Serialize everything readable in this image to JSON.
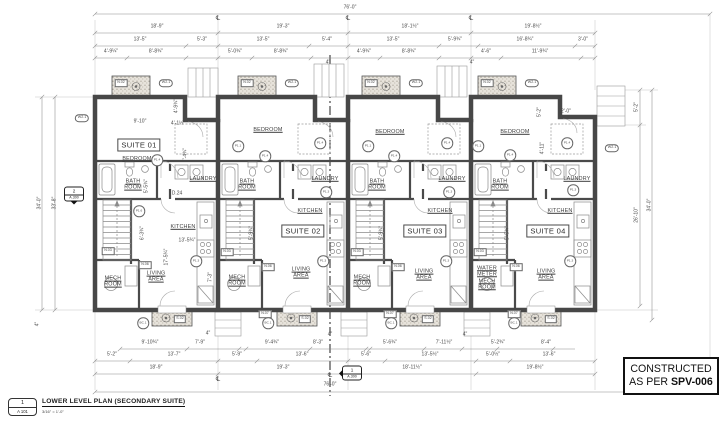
{
  "title_block": {
    "detail_number": "1",
    "sheet_ref": "A 101",
    "title": "LOWER LEVEL PLAN (SECONDARY SUITE)",
    "scale": "3/16\" = 1'-0\""
  },
  "stamp": {
    "line1": "CONSTRUCTED",
    "line2_prefix": "AS PER",
    "code": "SPV-006"
  },
  "plan": {
    "suite_labels": [
      {
        "t": "SUITE 01",
        "x": 139,
        "y": 145
      },
      {
        "t": "SUITE 02",
        "x": 303,
        "y": 231
      },
      {
        "t": "SUITE 03",
        "x": 425,
        "y": 231
      },
      {
        "t": "SUITE 04",
        "x": 548,
        "y": 231
      }
    ],
    "room_labels": [
      {
        "t": "BEDROOM",
        "x": 137,
        "y": 159
      },
      {
        "t": "BEDROOM",
        "x": 268,
        "y": 130
      },
      {
        "t": "BEDROOM",
        "x": 390,
        "y": 132
      },
      {
        "t": "BEDROOM",
        "x": 515,
        "y": 132
      },
      {
        "t": "BATH\nROOM",
        "x": 133,
        "y": 185
      },
      {
        "t": "BATH\nROOM",
        "x": 247,
        "y": 185
      },
      {
        "t": "BATH\nROOM",
        "x": 377,
        "y": 185
      },
      {
        "t": "BATH\nROOM",
        "x": 500,
        "y": 185
      },
      {
        "t": "LAUNDRY",
        "x": 203,
        "y": 179
      },
      {
        "t": "LAUNDRY",
        "x": 325,
        "y": 179
      },
      {
        "t": "LAUNDRY",
        "x": 452,
        "y": 179
      },
      {
        "t": "LAUNDRY",
        "x": 577,
        "y": 179
      },
      {
        "t": "KITCHEN",
        "x": 183,
        "y": 227
      },
      {
        "t": "KITCHEN",
        "x": 310,
        "y": 211
      },
      {
        "t": "KITCHEN",
        "x": 440,
        "y": 211
      },
      {
        "t": "KITCHEN",
        "x": 560,
        "y": 211
      },
      {
        "t": "LIVING\nAREA",
        "x": 156,
        "y": 277
      },
      {
        "t": "LIVING\nAREA",
        "x": 301,
        "y": 273
      },
      {
        "t": "LIVING\nAREA",
        "x": 424,
        "y": 275
      },
      {
        "t": "LIVING\nAREA",
        "x": 546,
        "y": 275
      },
      {
        "t": "MECH\nROOM",
        "x": 113,
        "y": 282
      },
      {
        "t": "MECH\nROOM",
        "x": 237,
        "y": 281
      },
      {
        "t": "MECH\nROOM",
        "x": 362,
        "y": 281
      },
      {
        "t": "WATER\nMETER\nMECH\nROOM",
        "x": 487,
        "y": 278
      }
    ],
    "dim_labels": [
      {
        "t": "76'-0\"",
        "x": 350,
        "y": 8
      },
      {
        "t": "18'-9\"",
        "x": 157,
        "y": 27
      },
      {
        "t": "19'-3\"",
        "x": 283,
        "y": 27
      },
      {
        "t": "18'-1½\"",
        "x": 410,
        "y": 27
      },
      {
        "t": "19'-8½\"",
        "x": 533,
        "y": 27
      },
      {
        "t": "13'-5\"",
        "x": 140,
        "y": 40
      },
      {
        "t": "5'-3\"",
        "x": 202,
        "y": 40
      },
      {
        "t": "13'-5\"",
        "x": 263,
        "y": 40
      },
      {
        "t": "5'-4\"",
        "x": 327,
        "y": 40
      },
      {
        "t": "13'-5\"",
        "x": 393,
        "y": 40
      },
      {
        "t": "5'-9¾\"",
        "x": 455,
        "y": 40
      },
      {
        "t": "16'-8¾\"",
        "x": 525,
        "y": 40
      },
      {
        "t": "3'-0\"",
        "x": 583,
        "y": 40
      },
      {
        "t": "4'-9¼\"",
        "x": 111,
        "y": 52
      },
      {
        "t": "8'-8¾\"",
        "x": 156,
        "y": 52
      },
      {
        "t": "5'-0¾\"",
        "x": 235,
        "y": 52
      },
      {
        "t": "8'-8¾\"",
        "x": 281,
        "y": 52
      },
      {
        "t": "4'-9¾\"",
        "x": 364,
        "y": 52
      },
      {
        "t": "8'-8¾\"",
        "x": 409,
        "y": 52
      },
      {
        "t": "4'-6\"",
        "x": 486,
        "y": 52
      },
      {
        "t": "11'-9¾\"",
        "x": 540,
        "y": 52
      },
      {
        "t": "4\"",
        "x": 328,
        "y": 63
      },
      {
        "t": "4\"",
        "x": 472,
        "y": 63
      },
      {
        "t": "9'-10¾\"",
        "x": 150,
        "y": 343
      },
      {
        "t": "7'-9\"",
        "x": 200,
        "y": 343
      },
      {
        "t": "9'-4¾\"",
        "x": 272,
        "y": 343
      },
      {
        "t": "8'-3\"",
        "x": 318,
        "y": 343
      },
      {
        "t": "5'-6¾\"",
        "x": 390,
        "y": 343
      },
      {
        "t": "7'-11½\"",
        "x": 444,
        "y": 343
      },
      {
        "t": "5'-2¾\"",
        "x": 498,
        "y": 343
      },
      {
        "t": "8'-4\"",
        "x": 546,
        "y": 343
      },
      {
        "t": "4\"",
        "x": 208,
        "y": 334
      },
      {
        "t": "4\"",
        "x": 330,
        "y": 335
      },
      {
        "t": "4\"",
        "x": 465,
        "y": 335
      },
      {
        "t": "5'-2\"",
        "x": 112,
        "y": 355
      },
      {
        "t": "13'-7\"",
        "x": 174,
        "y": 355
      },
      {
        "t": "5'-9\"",
        "x": 237,
        "y": 355
      },
      {
        "t": "13'-6\"",
        "x": 302,
        "y": 355
      },
      {
        "t": "5'-6\"",
        "x": 366,
        "y": 355
      },
      {
        "t": "13'-5½\"",
        "x": 430,
        "y": 355
      },
      {
        "t": "5'-0½\"",
        "x": 493,
        "y": 355
      },
      {
        "t": "13'-6\"",
        "x": 549,
        "y": 355
      },
      {
        "t": "18'-9\"",
        "x": 156,
        "y": 368
      },
      {
        "t": "19'-3\"",
        "x": 283,
        "y": 368
      },
      {
        "t": "18'-11½\"",
        "x": 412,
        "y": 368
      },
      {
        "t": "19'-8½\"",
        "x": 535,
        "y": 368
      },
      {
        "t": "76'-0\"",
        "x": 330,
        "y": 385
      },
      {
        "t": "34'-0\"",
        "x": 40,
        "y": 203,
        "r": 1
      },
      {
        "t": "33'-8\"",
        "x": 55,
        "y": 203,
        "r": 1
      },
      {
        "t": "4\"",
        "x": 38,
        "y": 324,
        "r": 1
      },
      {
        "t": "5'-2\"",
        "x": 637,
        "y": 107,
        "r": 1
      },
      {
        "t": "26'-10\"",
        "x": 637,
        "y": 215,
        "r": 1
      },
      {
        "t": "34'-0\"",
        "x": 650,
        "y": 205,
        "r": 1
      },
      {
        "t": "9'-10\"",
        "x": 140,
        "y": 122
      },
      {
        "t": "4'-1½\"",
        "x": 178,
        "y": 124
      },
      {
        "t": "4'-9¾\"",
        "x": 177,
        "y": 106,
        "r": 1
      },
      {
        "t": "7'-4¾\"",
        "x": 186,
        "y": 155,
        "r": 1
      },
      {
        "t": "5'-5¾\"",
        "x": 147,
        "y": 186,
        "r": 1
      },
      {
        "t": "13'-5¾\"",
        "x": 187,
        "y": 241
      },
      {
        "t": "6'-3¾\"",
        "x": 143,
        "y": 233,
        "r": 1
      },
      {
        "t": "17'-5¾\"",
        "x": 167,
        "y": 257,
        "r": 1
      },
      {
        "t": "7'-3\"",
        "x": 211,
        "y": 277,
        "r": 1
      },
      {
        "t": "5'-9¾\"",
        "x": 252,
        "y": 233,
        "r": 1
      },
      {
        "t": "5'-9¾\"",
        "x": 382,
        "y": 233,
        "r": 1
      },
      {
        "t": "5'-5¾\"",
        "x": 508,
        "y": 233,
        "r": 1
      },
      {
        "t": "5'-2\"",
        "x": 540,
        "y": 112,
        "r": 1
      },
      {
        "t": "2'-0\"",
        "x": 566,
        "y": 112
      },
      {
        "t": "4'-11\"",
        "x": 543,
        "y": 148,
        "r": 1
      },
      {
        "t": "D.24",
        "x": 177,
        "y": 194
      }
    ],
    "tags": [
      {
        "t": "N.02",
        "x": 121,
        "y": 83,
        "k": "box"
      },
      {
        "t": "N.02",
        "x": 247,
        "y": 83,
        "k": "box"
      },
      {
        "t": "N.02",
        "x": 371,
        "y": 83,
        "k": "box"
      },
      {
        "t": "N.02",
        "x": 487,
        "y": 83,
        "k": "box"
      },
      {
        "t": "W2.1",
        "x": 166,
        "y": 83,
        "k": "pill"
      },
      {
        "t": "W2.1",
        "x": 292,
        "y": 83,
        "k": "pill"
      },
      {
        "t": "W2.1",
        "x": 416,
        "y": 83,
        "k": "pill"
      },
      {
        "t": "W2.1",
        "x": 532,
        "y": 83,
        "k": "pill"
      },
      {
        "t": "W2.1",
        "x": 82,
        "y": 118,
        "k": "pill"
      },
      {
        "t": "W2.1",
        "x": 612,
        "y": 148,
        "k": "pill"
      },
      {
        "t": "S.02",
        "x": 180,
        "y": 319,
        "k": "box"
      },
      {
        "t": "S.02",
        "x": 305,
        "y": 319,
        "k": "box"
      },
      {
        "t": "S.02",
        "x": 428,
        "y": 319,
        "k": "box"
      },
      {
        "t": "S.02",
        "x": 551,
        "y": 319,
        "k": "box"
      },
      {
        "t": "N.07",
        "x": 265,
        "y": 314,
        "k": "box"
      },
      {
        "t": "N.07",
        "x": 390,
        "y": 314,
        "k": "box"
      },
      {
        "t": "N.07",
        "x": 514,
        "y": 314,
        "k": "box"
      },
      {
        "t": "BC.1",
        "x": 143,
        "y": 323,
        "k": "circ"
      },
      {
        "t": "BC.1",
        "x": 268,
        "y": 323,
        "k": "circ"
      },
      {
        "t": "BC.1",
        "x": 391,
        "y": 323,
        "k": "circ"
      },
      {
        "t": "BC.1",
        "x": 514,
        "y": 323,
        "k": "circ"
      },
      {
        "t": "P1.4",
        "x": 157,
        "y": 160,
        "k": "circ"
      },
      {
        "t": "P1.1",
        "x": 238,
        "y": 146,
        "k": "circ"
      },
      {
        "t": "P1.1",
        "x": 368,
        "y": 146,
        "k": "circ"
      },
      {
        "t": "P1.1",
        "x": 478,
        "y": 146,
        "k": "circ"
      },
      {
        "t": "P1.4",
        "x": 265,
        "y": 156,
        "k": "circ"
      },
      {
        "t": "P1.4",
        "x": 320,
        "y": 143,
        "k": "circ"
      },
      {
        "t": "P1.4",
        "x": 394,
        "y": 156,
        "k": "circ"
      },
      {
        "t": "P1.4",
        "x": 447,
        "y": 143,
        "k": "circ"
      },
      {
        "t": "P1.4",
        "x": 510,
        "y": 155,
        "k": "circ"
      },
      {
        "t": "P1.4",
        "x": 567,
        "y": 143,
        "k": "circ"
      },
      {
        "t": "P1.3",
        "x": 326,
        "y": 192,
        "k": "circ"
      },
      {
        "t": "P1.3",
        "x": 449,
        "y": 192,
        "k": "circ"
      },
      {
        "t": "P1.3",
        "x": 573,
        "y": 190,
        "k": "circ"
      },
      {
        "t": "P1.3",
        "x": 196,
        "y": 261,
        "k": "circ"
      },
      {
        "t": "P1.3",
        "x": 323,
        "y": 261,
        "k": "circ"
      },
      {
        "t": "P1.3",
        "x": 446,
        "y": 261,
        "k": "circ"
      },
      {
        "t": "P1.3",
        "x": 570,
        "y": 261,
        "k": "circ"
      },
      {
        "t": "N.03",
        "x": 108,
        "y": 251,
        "k": "box"
      },
      {
        "t": "N.03",
        "x": 227,
        "y": 252,
        "k": "box"
      },
      {
        "t": "N.03",
        "x": 357,
        "y": 252,
        "k": "box"
      },
      {
        "t": "N.03",
        "x": 480,
        "y": 252,
        "k": "box"
      },
      {
        "t": "N.06",
        "x": 145,
        "y": 265,
        "k": "box"
      },
      {
        "t": "N.06",
        "x": 268,
        "y": 267,
        "k": "box"
      },
      {
        "t": "N.06",
        "x": 398,
        "y": 267,
        "k": "box"
      },
      {
        "t": "N.06",
        "x": 516,
        "y": 267,
        "k": "box"
      },
      {
        "t": "P1.6",
        "x": 139,
        "y": 211,
        "k": "circ"
      }
    ],
    "centerline_symbol": "℄",
    "centerline_positions": [
      {
        "x": 218,
        "y": 19
      },
      {
        "x": 348,
        "y": 19
      },
      {
        "x": 471,
        "y": 19
      },
      {
        "x": 218,
        "y": 380
      },
      {
        "x": 330,
        "y": 376
      }
    ]
  },
  "section_markers": [
    {
      "number": "2",
      "sheet": "A.300",
      "x": 74,
      "y": 194,
      "dir": "down"
    },
    {
      "number": "1",
      "sheet": "A.300",
      "x": 352,
      "y": 373,
      "dir": "left"
    }
  ]
}
